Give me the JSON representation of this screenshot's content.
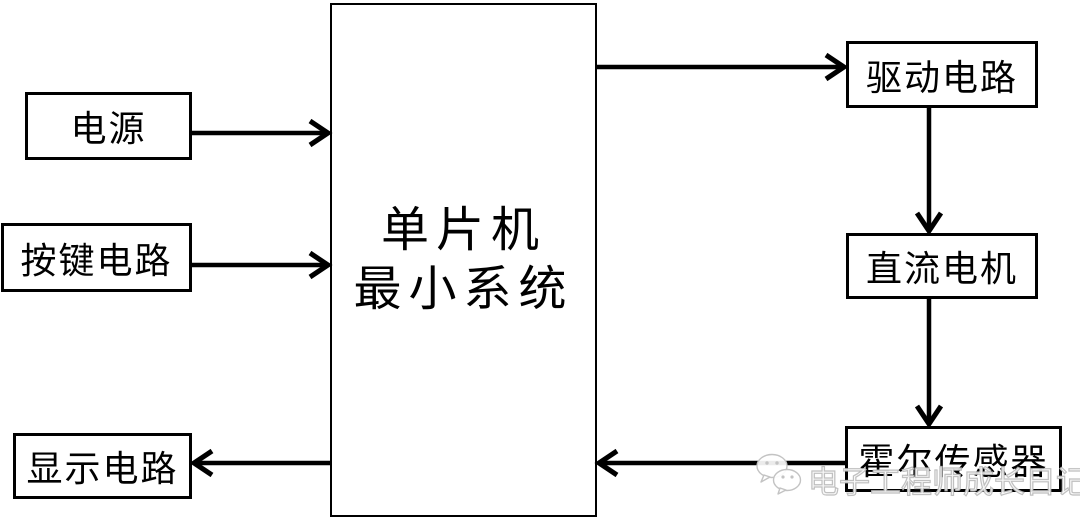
{
  "page": {
    "width": 1080,
    "height": 520,
    "background": "#ffffff"
  },
  "colors": {
    "line": "#000000",
    "box_border": "#000000",
    "box_background": "#ffffff",
    "text": "#000000",
    "watermark": "#bdbdbd"
  },
  "diagram": {
    "nodes": [
      {
        "id": "power",
        "label": "电源"
      },
      {
        "id": "key-circuit",
        "label": "按键电路"
      },
      {
        "id": "display-circuit",
        "label": "显示电路"
      },
      {
        "id": "mcu",
        "label_line1": "单片机",
        "label_line2": "最小系统"
      },
      {
        "id": "drive-circuit",
        "label": "驱动电路"
      },
      {
        "id": "dc-motor",
        "label": "直流电机"
      },
      {
        "id": "hall-sensor",
        "label": "霍尔传感器"
      }
    ],
    "edges": [
      {
        "from": "power",
        "to": "mcu"
      },
      {
        "from": "key-circuit",
        "to": "mcu"
      },
      {
        "from": "mcu",
        "to": "drive-circuit"
      },
      {
        "from": "drive-circuit",
        "to": "dc-motor"
      },
      {
        "from": "dc-motor",
        "to": "hall-sensor"
      },
      {
        "from": "hall-sensor",
        "to": "mcu"
      },
      {
        "from": "mcu",
        "to": "display-circuit"
      }
    ]
  },
  "watermark": {
    "icon": "wechat-icon",
    "text": "电子工程师成长日记"
  }
}
